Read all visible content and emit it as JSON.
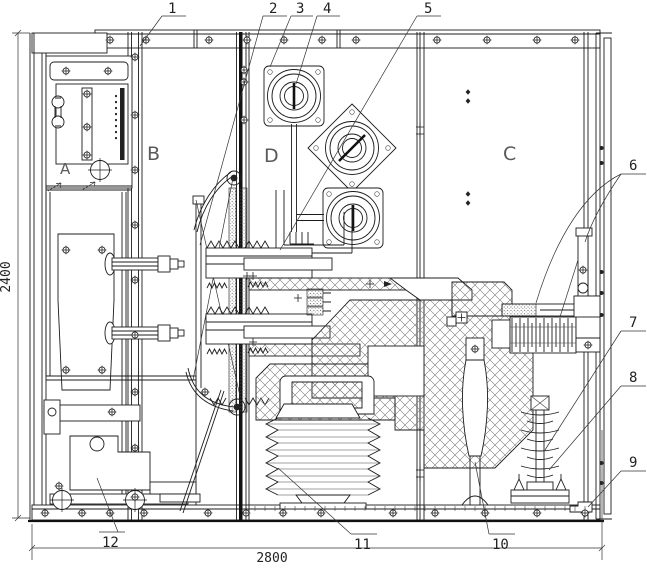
{
  "callouts": {
    "c1": "1",
    "c2": "2",
    "c3": "3",
    "c4": "4",
    "c5": "5",
    "c6": "6",
    "c7": "7",
    "c8": "8",
    "c9": "9",
    "c10": "10",
    "c11": "11",
    "c12": "12"
  },
  "compartments": {
    "a": "A",
    "b": "B",
    "c": "C",
    "d": "D"
  },
  "dims": {
    "h": "2400",
    "w": "2800"
  },
  "colors": {
    "line": "#1c1c1c",
    "hatch": "#6a6a6a",
    "background": "#ffffff"
  }
}
